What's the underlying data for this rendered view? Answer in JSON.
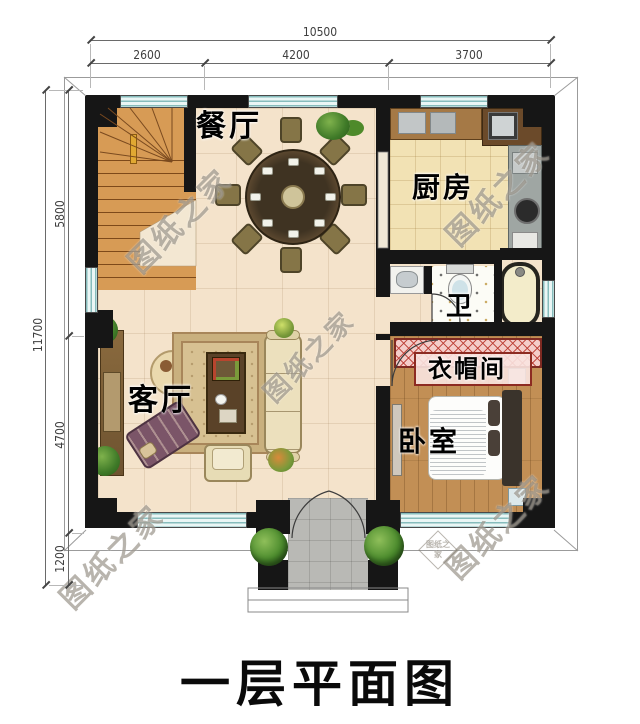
{
  "title": "一层平面图",
  "watermark": {
    "text": "图纸之家"
  },
  "dimensions": {
    "top": {
      "total": "10500",
      "segments": [
        "2600",
        "4200",
        "3700"
      ]
    },
    "left": {
      "total": "11700",
      "segments": [
        "5800",
        "4700",
        "1200"
      ]
    }
  },
  "rooms": {
    "dining": {
      "label": "餐厅"
    },
    "kitchen": {
      "label": "厨房"
    },
    "bathroom": {
      "label": "卫"
    },
    "cloakroom": {
      "label": "衣帽间"
    },
    "bedroom": {
      "label": "卧室"
    },
    "living": {
      "label": "客厅"
    }
  },
  "colors": {
    "wall": "#161616",
    "floor_tile": "#f4e3cb",
    "kitchen_floor": "#f2e2b4",
    "wood_floor": "#c28f55",
    "stair_wood": "#d79b55",
    "window": "#bfe0de",
    "wardrobe_hatch": "#f4cdc9",
    "porch_floor": "#b9b9b5",
    "plant_green": "#4e8a2e",
    "title_text": "#0a0a0a"
  }
}
